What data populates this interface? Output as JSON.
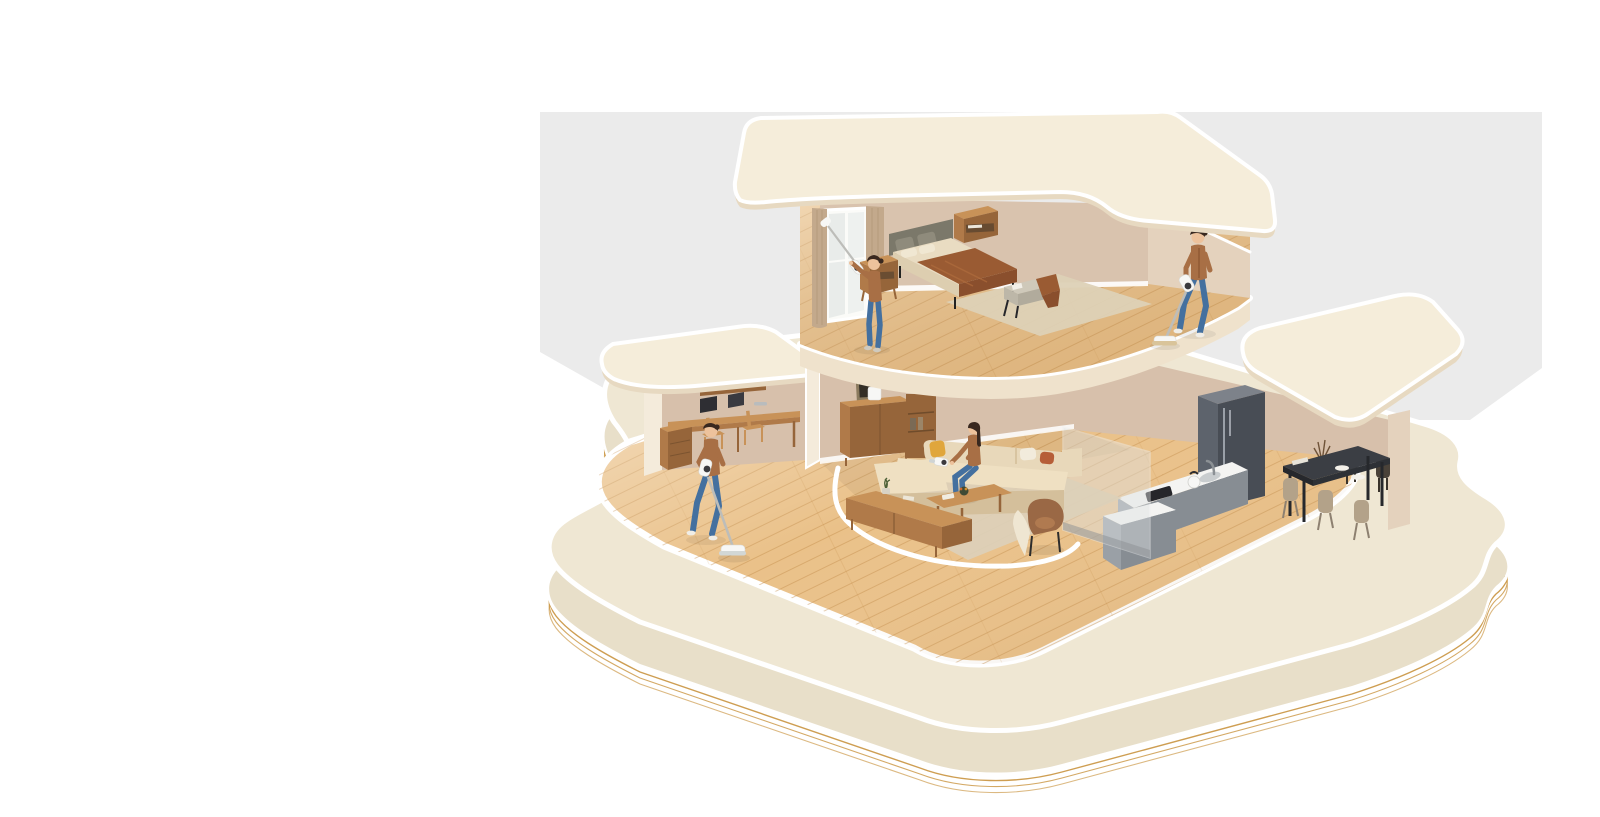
{
  "meta": {
    "width": 1600,
    "height": 817,
    "kind": "3d-isometric-cutaway-house-illustration"
  },
  "scene": {
    "description": "Isometric cutaway 3D render of a two-story home on a rounded cream base with layered gold contour edges; four people clean wood floors, a window, and a sofa using white cordless stick and handheld vacuums",
    "people_count": 4,
    "people": [
      {
        "id": "window-cleaner",
        "location": "upper-floor bedroom",
        "activity": "dusting a floor-to-ceiling window with an extended cordless vacuum",
        "outfit": "brown sweater, blue jeans"
      },
      {
        "id": "upstairs-vacuumer",
        "location": "upper-floor landing",
        "activity": "vacuuming the wood floor with a cordless stick vacuum",
        "outfit": "brown cardigan, blue jeans"
      },
      {
        "id": "sofa-cleaner",
        "location": "living room",
        "activity": "cleaning sofa cushions with a handheld vacuum while seated",
        "outfit": "brown top, blue jeans"
      },
      {
        "id": "floor-mopper",
        "location": "ground-floor hallway",
        "activity": "wet-mopping the wood floor with a cordless wet-dry vacuum",
        "outfit": "brown sweater, blue jeans"
      }
    ],
    "floors": [
      {
        "name": "upper-floor",
        "rooms": [
          {
            "name": "bedroom",
            "furniture": [
              "double bed with gray upholstered headboard and brown throw blanket",
              "two wooden nightstands",
              "gray fabric bench with book and brown throw",
              "beige area rug",
              "floor-to-ceiling window with tan curtains"
            ]
          },
          {
            "name": "landing",
            "furniture": [
              "open wood floor"
            ]
          }
        ]
      },
      {
        "name": "ground-floor",
        "rooms": [
          {
            "name": "study",
            "furniture": [
              "wall-length wooden desk",
              "two dark laptops",
              "two wooden chairs",
              "wooden drawer cabinet",
              "overhead wood cabinet"
            ]
          },
          {
            "name": "living-room",
            "furniture": [
              "beige L-shaped sectional sofa",
              "yellow, white and rust throw pillows",
              "wooden coffee table with fruit bowl",
              "long wooden TV console with plant",
              "brown lounge chair with beige throw",
              "wooden sideboard with white appliance",
              "framed wall art",
              "shelf unit with black table lamp",
              "large beige rug"
            ]
          },
          {
            "name": "kitchen",
            "furniture": [
              "gray double-door refrigerator",
              "counter with sink, faucet, kettle and black cooktop",
              "gray island",
              "translucent glass partition"
            ]
          },
          {
            "name": "dining-room",
            "furniture": [
              "dark rectangular dining table",
              "two dark and three beige chairs",
              "white plates",
              "vase with dried plant",
              "roof support column"
            ]
          }
        ]
      }
    ],
    "style": {
      "base": "rounded cream platform, white rim, thin layered gold contour lines around the edge",
      "flooring": "light oak planks",
      "walls": "warm beige",
      "backdrop": "light gray studio wall, white page background"
    }
  },
  "colors": {
    "background": "#ffffff",
    "backdrop": "#ebebeb",
    "roof": "#f5edda",
    "roof_edge": "#e7d9c1",
    "platform_top": "#efe7d3",
    "platform_side": "#e8dfc9",
    "ripple": "#c9943f",
    "wood": "#eac189",
    "plank": "#c28c49",
    "slab_under": "#efe2cc",
    "wall_in": "#d7c0ab",
    "wall_up": "#d9c3ae",
    "wall_lit": "#e4d2bd",
    "wall_edge": "#f4ebdb",
    "curtain": "#c3a98c",
    "headboard": "#7b786a",
    "bedding": "#e9dcc2",
    "blanket": "#9a5b33",
    "bench": "#cfc9ba",
    "rug_bed": "#ddd1b6",
    "rug_living": "#dcd0ba",
    "wood_furn": "#b07a49",
    "wood_furn_dark": "#96653a",
    "wood_furn_light": "#c89258",
    "sofa": "#e8d8ba",
    "sofa_seat": "#efe0c2",
    "sofa_shadow": "#d4bf9b",
    "armchair": "#9a6845",
    "fridge": "#5d636c",
    "fridge_dark": "#484d55",
    "counter": "#f4f4f2",
    "cabinet_gray": "#9aa0a6",
    "cabinet_gray_dark": "#878d93",
    "glass": "#dfe3e4",
    "table_dark": "#3b3e44",
    "chair_beige": "#b3a289",
    "chair_dark": "#4a4239",
    "skin": "#edc29c",
    "hair": "#39281f",
    "sweater": "#a86f45",
    "denim": "#44709f",
    "metal": "#bdbdb9",
    "vacuum": "#f7f7f5",
    "pillow_yellow": "#e0a63c",
    "pillow_rust": "#b65e38",
    "pillow_white": "#f2ebdc"
  }
}
